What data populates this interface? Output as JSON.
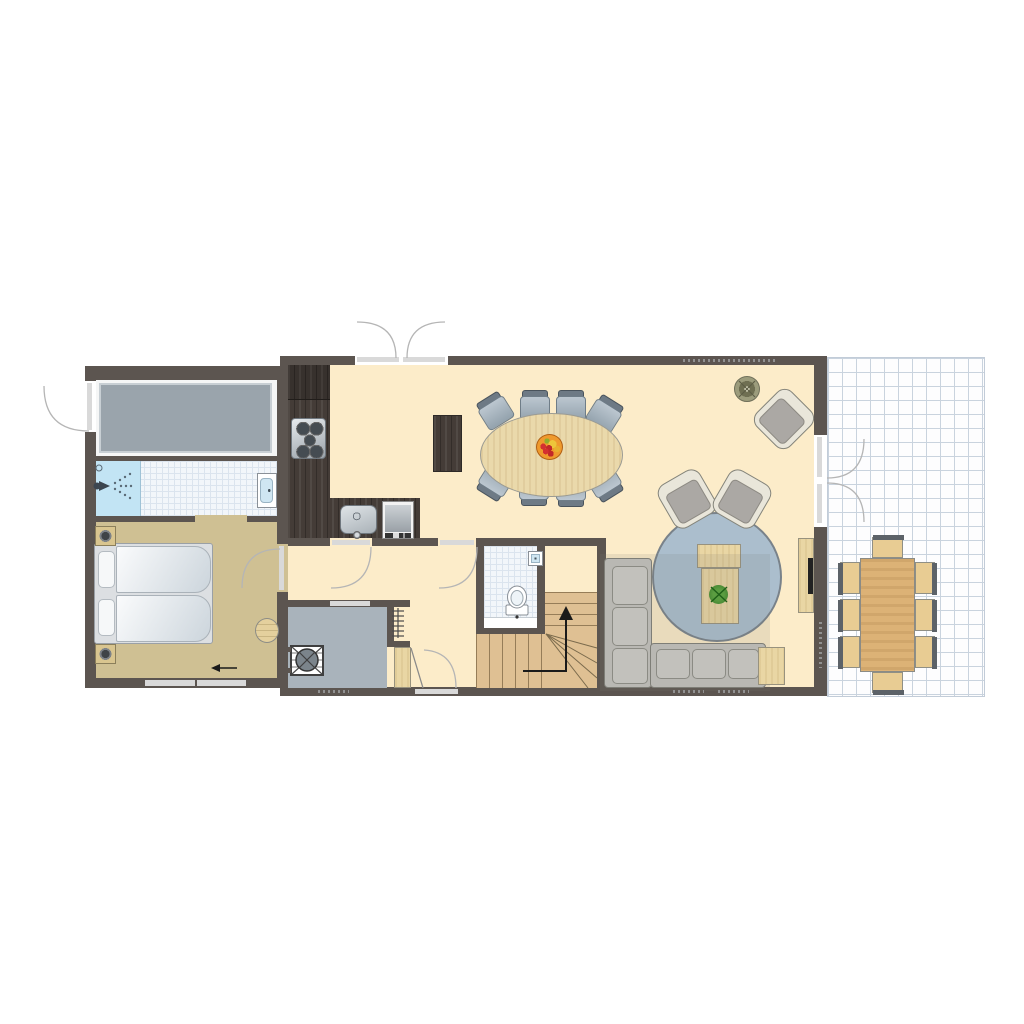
{
  "plan": {
    "kind": "residential-ground-floor-plan",
    "rooms": [
      {
        "name": "storage-room",
        "floor": "light"
      },
      {
        "name": "bathroom",
        "features": [
          "shower",
          "washbasin"
        ],
        "floor": "tiled"
      },
      {
        "name": "bedroom",
        "features": [
          "double-bed",
          "two-nightstands",
          "stool"
        ],
        "floor": "tan"
      },
      {
        "name": "kitchen",
        "features": [
          "l-shaped-counter",
          "stove-4-burners",
          "sink",
          "dishwasher"
        ]
      },
      {
        "name": "dining-area",
        "features": [
          "oval-table",
          "8-chairs",
          "fruit-bowl",
          "tall-cabinet"
        ]
      },
      {
        "name": "living-area",
        "features": [
          "round-rug",
          "corner-sofa",
          "2-armchairs",
          "corner-armchair",
          "coffee-table",
          "side-table",
          "sideboard-tv",
          "potted-plant"
        ]
      },
      {
        "name": "hallway",
        "features": [
          "radiator",
          "wardrobe-closet"
        ]
      },
      {
        "name": "wc",
        "features": [
          "toilet",
          "small-basin"
        ],
        "floor": "tiled"
      },
      {
        "name": "staircase",
        "direction": "up",
        "shape": "winder"
      },
      {
        "name": "technical-room",
        "features": [
          "ventilation-unit"
        ],
        "floor": "gray"
      },
      {
        "name": "terrace",
        "features": [
          "outdoor-table",
          "8-outdoor-chairs"
        ],
        "floor": "tiled-grid"
      }
    ],
    "counts": {
      "dining_chairs": 8,
      "terrace_chairs": 8,
      "stove_burners": 5,
      "armchairs": 3,
      "beds": 1,
      "doors_double": 2
    },
    "doors": [
      "entrance-double-door-top",
      "storage-exterior-door-left",
      "bedroom-door",
      "kitchen-hall-door",
      "dining-hall-door",
      "closet-door",
      "terrace-double-door-right",
      "wc-threshold"
    ],
    "windows": [
      "bedroom-window-1",
      "bedroom-window-2",
      "hall-bottom-window",
      "technical-room-window"
    ],
    "vents": [
      "top-wall-vent",
      "tech-room-vent",
      "living-bottom-vent-1",
      "living-bottom-vent-2",
      "right-wall-vent"
    ]
  },
  "colors": {
    "wall": "#5c5550",
    "floor-main": "#fcecc9",
    "floor-bedroom": "#cfc093",
    "floor-tech": "#a9b3bb",
    "unit-gray": "#9aa4ac",
    "shower": "#c2e4f4",
    "tile-grid": "#dbe4ee",
    "counter": "#443c37",
    "wood": "#e9d6a4",
    "stairs-wood": "#dfc093",
    "terrace-wood": "#dcb276",
    "terrace-chair": "#e8cc93",
    "rug": "#abbecd",
    "sofa": "#b9b8b3",
    "sofa-line": "#7e7e77",
    "chair-seat": "#93a2ad",
    "chair-back": "#6e7a85",
    "shell": "#e9e6da",
    "cushion": "#aba8a4",
    "metal-dark": "#9aa2a9",
    "door-leaf": "#d9d9d9",
    "arc": "#b5b5b5",
    "grid": "#c9d3de",
    "vent-dot": "#919191",
    "bowl": "#ef9a2d",
    "fruit-red": "#d43030",
    "fruit-yellow": "#eec63a",
    "plant-pot": "#9c9c7c",
    "plant-green": "#4f9a2f",
    "tv": "#222222"
  }
}
